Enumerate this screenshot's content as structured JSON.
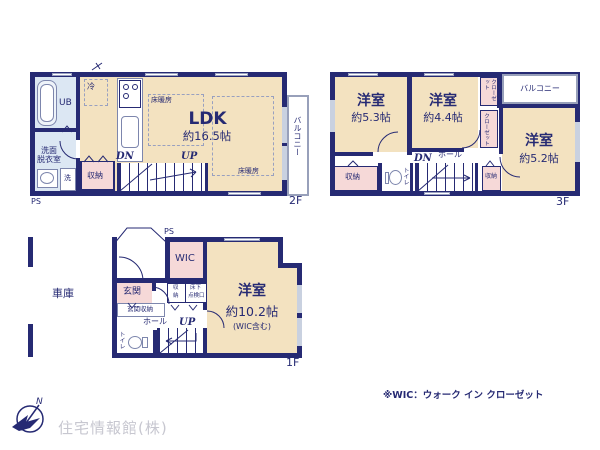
{
  "palette": {
    "wall": "#262a73",
    "room_beige": "#f3e2c0",
    "closet_pink": "#f6d9d8",
    "bath_blue": "#dce7f3",
    "text_navy": "#262a73",
    "company_gray": "#c7c7d0"
  },
  "plan2f": {
    "floor_label": "2F",
    "ps": "PS",
    "ldk": {
      "name": "LDK",
      "size": "約16.5帖"
    },
    "ub": "UB",
    "washroom": [
      "洗面",
      "脱衣室"
    ],
    "laundry": "洗",
    "fridge": "冷",
    "floor_heating": "床暖房",
    "storage": "収納",
    "balcony": "バルコニー",
    "dn": "DN",
    "up": "UP"
  },
  "plan3f": {
    "floor_label": "3F",
    "room_a": {
      "name": "洋室",
      "size": "約5.3帖"
    },
    "room_b": {
      "name": "洋室",
      "size": "約4.4帖"
    },
    "room_c": {
      "name": "洋室",
      "size": "約5.2帖"
    },
    "closet_a": "クローゼット",
    "closet_b": "クローゼット",
    "balcony": "バルコニー",
    "hall": "ホール",
    "toilet": "トイレ",
    "storage_w": "収納",
    "storage_e": "収納",
    "dn": "DN"
  },
  "plan1f": {
    "floor_label": "1F",
    "ps": "PS",
    "garage": "車庫",
    "bedroom": {
      "name": "洋室",
      "size": "約10.2帖",
      "note": "(WIC含む)"
    },
    "wic": "WIC",
    "entrance": "玄関",
    "entrance_storage": "玄関収納",
    "storage": [
      "収",
      "納"
    ],
    "floor_hatch": [
      "床下",
      "点検口"
    ],
    "hall": "ホール",
    "toilet": "トイレ",
    "up": "UP"
  },
  "footer": {
    "wic_note": "※WIC：ウォーク イン クローゼット",
    "company": "住宅情報館(株)",
    "compass_n": "N"
  }
}
